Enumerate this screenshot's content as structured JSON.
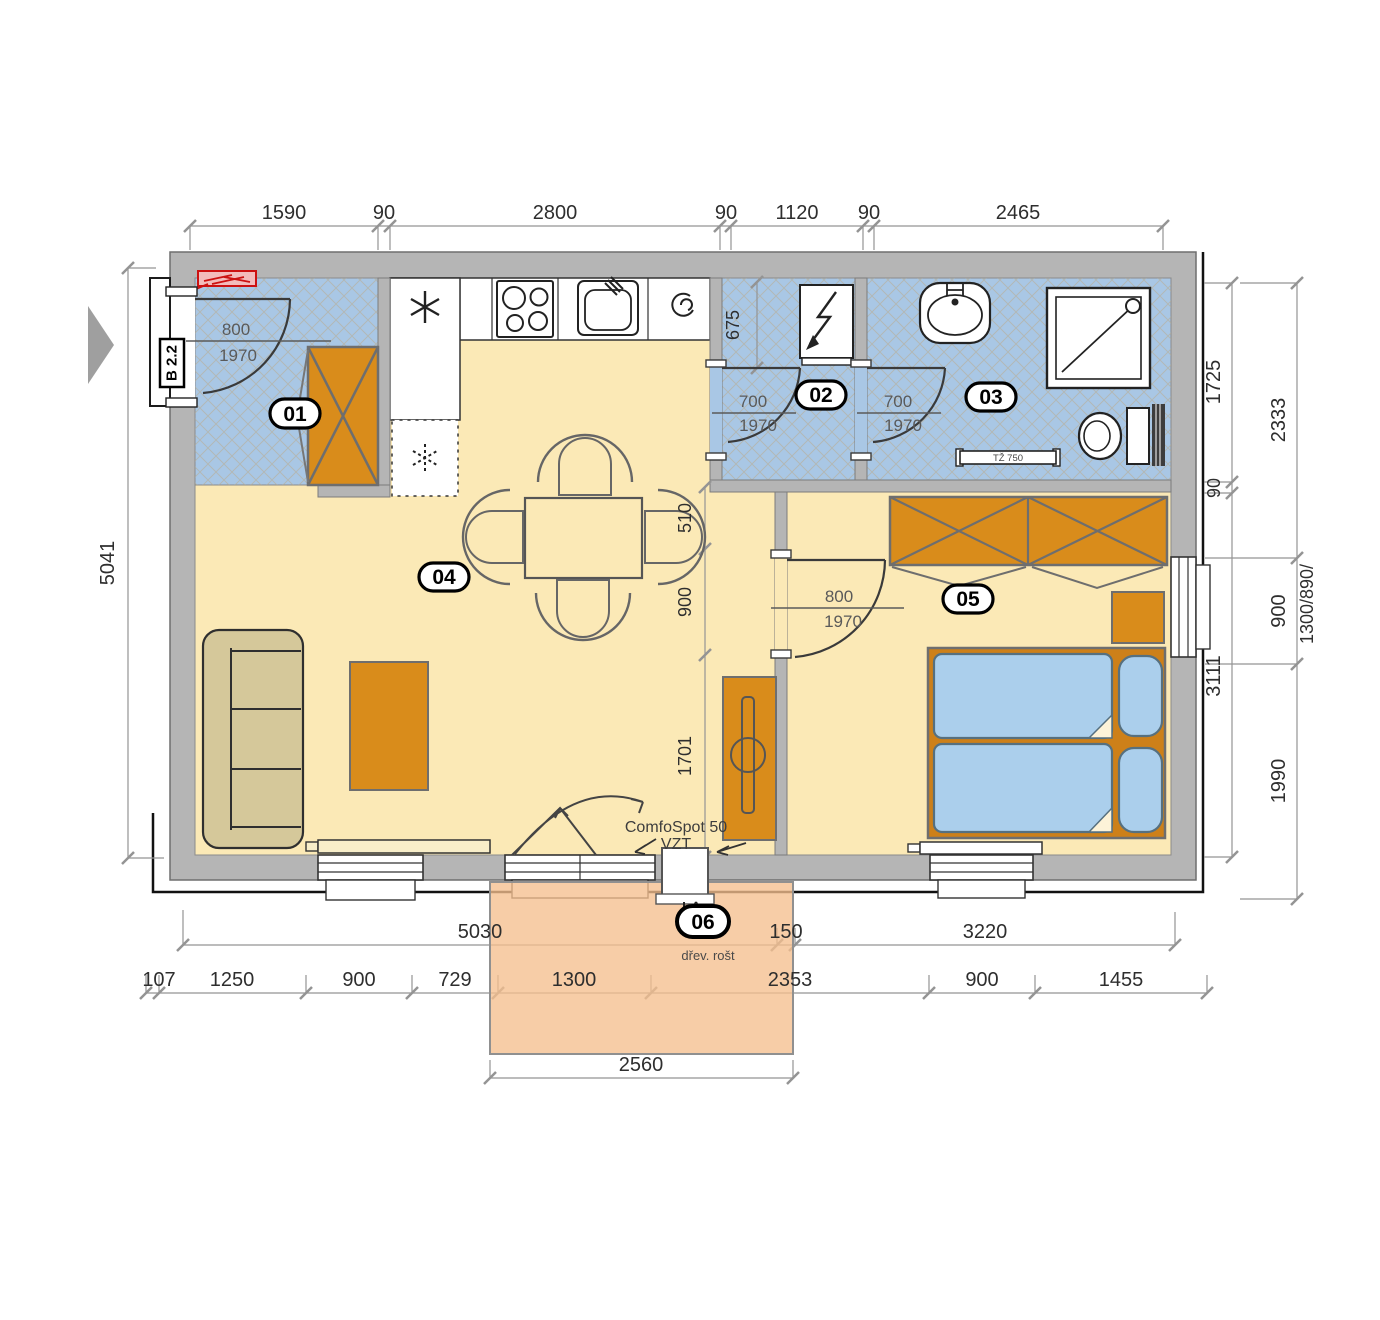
{
  "rooms": {
    "r01": "01",
    "r02": "02",
    "r03": "03",
    "r04": "04",
    "r05": "05",
    "r06": "06"
  },
  "doors": {
    "entry": {
      "w": "800",
      "h": "1970"
    },
    "d02": {
      "w": "700",
      "h": "1970"
    },
    "d03": {
      "w": "700",
      "h": "1970"
    },
    "d05": {
      "w": "800",
      "h": "1970"
    }
  },
  "labels": {
    "entry_door_tag": "B 2.2",
    "vent_1": "ComfoSpot 50",
    "vent_2": "VZT",
    "terrace_note": "dřev. rošt",
    "towel_radiator": "TŽ 750"
  },
  "dims": {
    "top": [
      "1590",
      "90",
      "2800",
      "90",
      "1120",
      "90",
      "2465"
    ],
    "left_total": "5041",
    "right_inner": [
      "1725",
      "90",
      "3111"
    ],
    "right_outer": [
      "2333",
      "900",
      "1990"
    ],
    "right_window": "1300/890/",
    "interior": [
      "510",
      "900",
      "1701"
    ],
    "room02_depth": "675",
    "bottom_a": [
      "5030",
      "150",
      "3220"
    ],
    "bottom_b": [
      "107",
      "1250",
      "900",
      "729",
      "1300",
      "2353",
      "900",
      "1455"
    ],
    "terrace_width": "2560"
  },
  "colors": {
    "wall": "#b5b5b5",
    "floor_main": "#fbe9b6",
    "floor_wet": "#a9c7e5",
    "furniture_orange": "#d98c1b",
    "bed_frame": "#cd8019",
    "bedding_blue": "#abcfec",
    "sofa_tan": "#d5c89a",
    "terrace": "#f5bf8e",
    "radiator_red": "#cc1111"
  }
}
